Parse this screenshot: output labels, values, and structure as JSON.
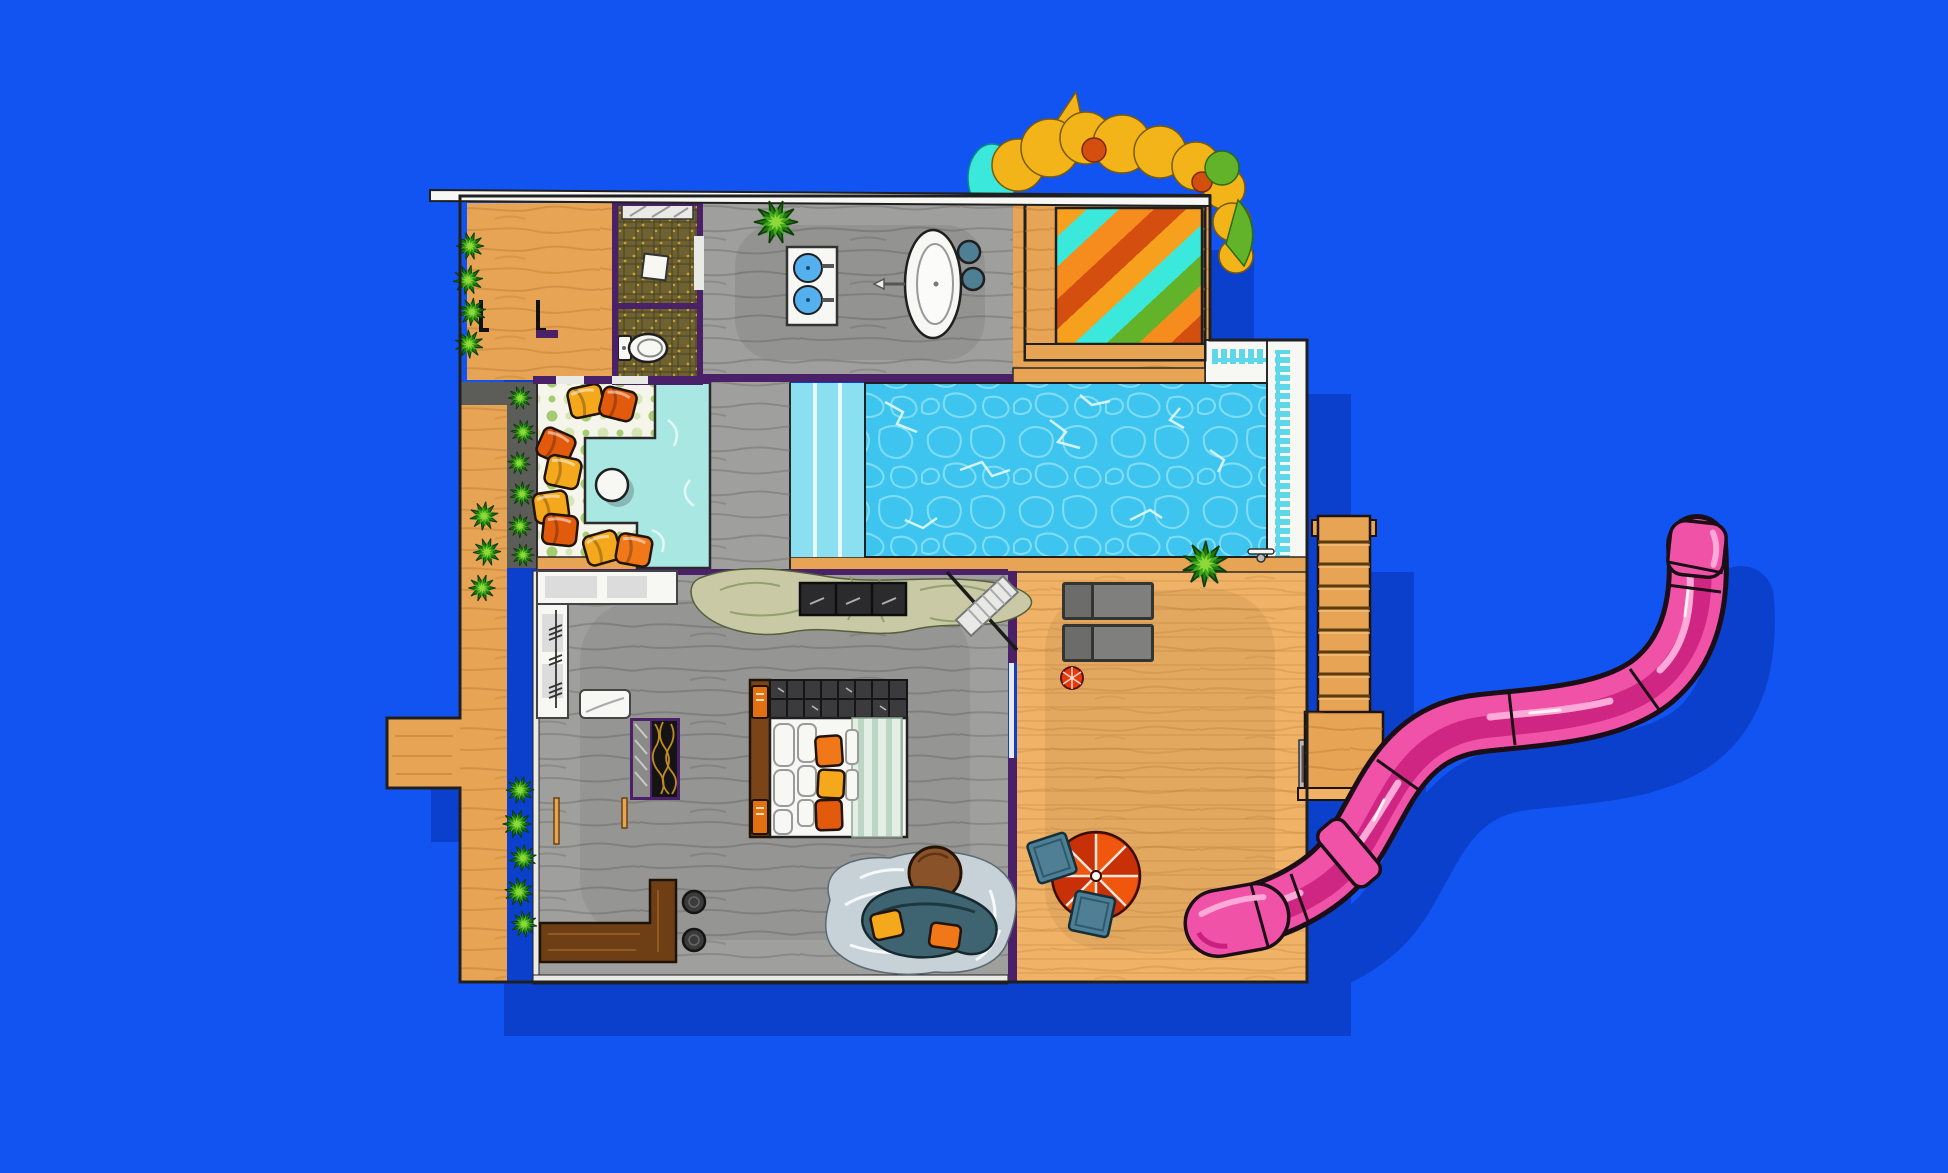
{
  "meta": {
    "description": "Top-down cartoon floor plan illustration of a pool villa with wooden decks, swimming pool, plunge pool, bedroom, bathroom, garden bushes, wooden stairs and a curving pink water slide on a flat blue background",
    "canvas": {
      "width": 1948,
      "height": 1173
    },
    "stairs_rungs": 8,
    "umbrella_slices": 8,
    "awning_stripe_order": [
      "orange",
      "cyan",
      "deep-orange",
      "red",
      "orange",
      "cyan",
      "green",
      "deep-orange",
      "red"
    ]
  },
  "colors": {
    "background": "#1254F2",
    "shadow": "#0B40CC",
    "outline": "#1F1F1F",
    "wood": "#E8A455",
    "wood_light": "#EFB266",
    "wood_deep": "#B97B2E",
    "wood_edge": "#8A5A1E",
    "gray_floor": "#9FA09D",
    "gray_streak": "#70706C",
    "wall_white": "#E9E9E6",
    "purple_wall": "#4A2168",
    "mosaic": "#6E6233",
    "mosaic_grid": "#3A3316",
    "mosaic_dot": "#C9A22C",
    "pool_water": "#3EC5EF",
    "pool_pebble": "#92E3F6",
    "pool_crack": "#E4F9FE",
    "pool_steps": "#8ADFF0",
    "tile_band": "#5ED7E8",
    "plunge": "#A9E7E3",
    "plunge_swirl": "#E8FAF7",
    "dots_bg": "#F5F5EC",
    "dot_green": "#A6CC72",
    "dot_pale": "#D6E5B5",
    "planter": "#5C5C58",
    "plant_dark": "#1F7A10",
    "plant_mid": "#43AC1D",
    "plant_light": "#8FD83A",
    "white": "#F7F7F4",
    "sink_blue": "#55B1EE",
    "stool_slate": "#4E7F95",
    "bed_head": "#3B3B3E",
    "bed_tile": "#4B4B4F",
    "bed_rail": "#7A4418",
    "book_orange": "#E07010",
    "duvet_bg": "#E3EFE5",
    "duvet_stripe": "#BCD6C4",
    "cushion_orange": "#F07818",
    "cushion_deep": "#E25A0C",
    "cushion_yellow": "#F5A81C",
    "console": "#2B2B2D",
    "rug_sage": "#C9C9A6",
    "rug_leaf": "#8C9E66",
    "rug_blue": "#C7D2D8",
    "couch": "#3D6470",
    "couch_dark": "#1E3840",
    "pouf": "#8A5228",
    "bench_brown": "#6E3E14",
    "bench_grain": "#9A6228",
    "stool_dark": "#3B3B3B",
    "lounger": "#6C6C6A",
    "lounger_panel": "#7F7F7D",
    "lounger_frame": "#343432",
    "umbrella_a": "#F0560E",
    "umbrella_b": "#C83008",
    "ball_red": "#E8380A",
    "kitchen_panel": "#DCDCDC",
    "wardrobe_gold": "#C08A1E",
    "awn_orange": "#F7A01E",
    "awn_cyan": "#3BE9DC",
    "awn_deep": "#F78C1E",
    "awn_red": "#D44E10",
    "awn_green": "#63B32A",
    "tree_yellow": "#F2B418",
    "slide_pink": "#F052A8",
    "slide_dark": "#C91F7E",
    "slide_light": "#FFA9D8",
    "slide_outline": "#1C0E16"
  },
  "scene": {
    "objects": [
      "roof-edge",
      "wood-lounge-room",
      "shower-room",
      "toilet-room",
      "toilet",
      "bathroom-floor",
      "double-sink-vanity",
      "bathtub",
      "bathtub-stools",
      "striped-awning-canopy",
      "tree-foliage",
      "courtyard-polka-floor",
      "floor-cushions",
      "courtyard-side-table",
      "plunge-pool",
      "walkway-bridge",
      "swimming-pool",
      "pool-steps",
      "pool-tile-walkway",
      "poolside-shower",
      "kitchen-counter",
      "towel-rail",
      "kitchen-basin",
      "wardrobe",
      "hall-rug",
      "media-console",
      "towel-bench",
      "bed",
      "bed-pillows",
      "bed-cushions",
      "bedside-books",
      "living-rug",
      "curved-sofa",
      "sofa-cushions",
      "round-pouf",
      "bar-bench",
      "bar-stools",
      "sun-loungers",
      "beach-ball",
      "patio-umbrella",
      "patio-cushions",
      "deck-gate",
      "wooden-stairs",
      "stair-platform",
      "water-slide",
      "slide-entrance",
      "slide-exit",
      "garden-bushes",
      "house-shadow"
    ]
  }
}
